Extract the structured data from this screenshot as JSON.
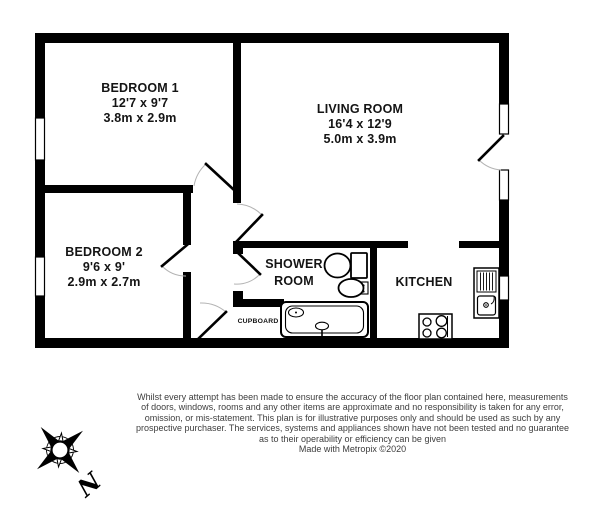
{
  "page": {
    "background": "#ffffff",
    "wall_color": "#000000",
    "door_arc_color": "#b3b3b3",
    "label_color": "#141414",
    "footer_color": "#3d3d3d"
  },
  "rooms": {
    "bedroom1": {
      "name": "BEDROOM 1",
      "imperial": "12'7 x 9'7",
      "metric": "3.8m x 2.9m"
    },
    "living": {
      "name": "LIVING ROOM",
      "imperial": "16'4 x 12'9",
      "metric": "5.0m x 3.9m"
    },
    "bedroom2": {
      "name": "BEDROOM 2",
      "imperial": "9'6 x 9'",
      "metric": "2.9m x 2.7m"
    },
    "shower": {
      "line1": "SHOWER",
      "line2": "ROOM"
    },
    "kitchen": {
      "name": "KITCHEN"
    },
    "cupboard": {
      "name": "CUPBOARD"
    }
  },
  "compass": {
    "north_label": "N"
  },
  "footer": {
    "lines": [
      "Whilst every attempt has been made to ensure the accuracy of the floor plan contained here, measurements",
      "of doors, windows, rooms and any other items are approximate and no responsibility is taken for any error,",
      "omission, or mis-statement. This plan is for illustrative purposes only and should be used as such by any",
      "prospective purchaser. The services, systems and appliances shown have not been tested and no guarantee",
      "as to their operability or efficiency can be given"
    ],
    "credit": "Made with Metropix ©2020"
  }
}
